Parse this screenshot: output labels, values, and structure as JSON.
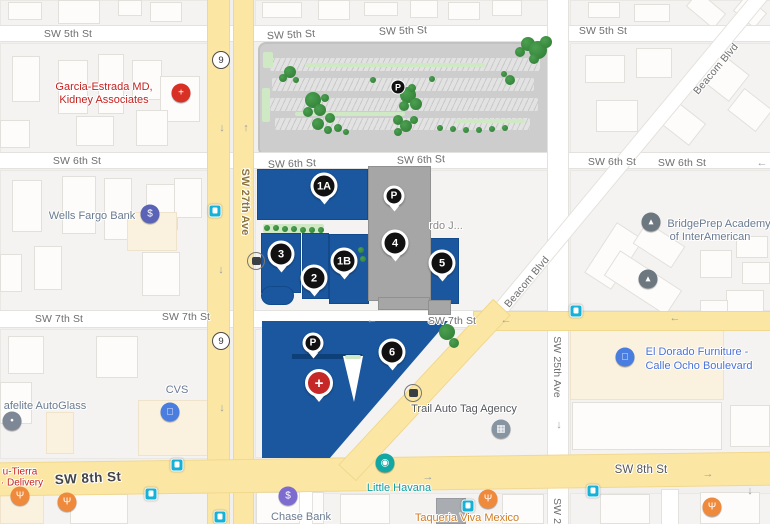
{
  "colors": {
    "campus_blue": "#1b579e",
    "building_gray": "#a6a6a6",
    "road_yellow": "#fbe7a3",
    "map_bg": "#f2f0ee",
    "tree_green": "#2e7a33",
    "transit_teal": "#16b1d6"
  },
  "streets": [
    {
      "t": "SW 5th St",
      "x": 68,
      "y": 34
    },
    {
      "t": "SW 5th St",
      "x": 291,
      "y": 35,
      "rot": -3
    },
    {
      "t": "SW 5th St",
      "x": 403,
      "y": 31,
      "rot": -2
    },
    {
      "t": "SW 5th St",
      "x": 603,
      "y": 31
    },
    {
      "t": "SW 6th St",
      "x": 77,
      "y": 161
    },
    {
      "t": "SW 6th St",
      "x": 292,
      "y": 164,
      "rot": -2
    },
    {
      "t": "SW 6th St",
      "x": 421,
      "y": 160,
      "rot": -2
    },
    {
      "t": "SW 6th St",
      "x": 612,
      "y": 162
    },
    {
      "t": "SW 6th St",
      "x": 682,
      "y": 163
    },
    {
      "t": "SW 7th St",
      "x": 59,
      "y": 319
    },
    {
      "t": "SW 7th St",
      "x": 186,
      "y": 317
    },
    {
      "t": "SW 7th St",
      "x": 452,
      "y": 321
    },
    {
      "t": "SW 8th St",
      "x": 88,
      "y": 478,
      "cls": "big",
      "rot": -3
    },
    {
      "t": "SW 8th St",
      "x": 641,
      "y": 470,
      "cls": "mid"
    },
    {
      "t": "SW 27th Ave",
      "x": 245,
      "y": 202,
      "cls": "vert ave27"
    },
    {
      "t": "SW 25th Ave",
      "x": 557,
      "y": 367,
      "cls": "vert"
    },
    {
      "t": "SW 25",
      "x": 557,
      "y": 514,
      "cls": "vert"
    },
    {
      "t": "Beacom Blvd",
      "x": 716,
      "y": 69,
      "rot": -50
    },
    {
      "t": "Beacom Blvd",
      "x": 527,
      "y": 282,
      "rot": -50
    }
  ],
  "pois": [
    {
      "t": "Garcia-Estrada MD,",
      "x": 104,
      "y": 87,
      "c": "red"
    },
    {
      "t": "Kidney Associates",
      "x": 104,
      "y": 100,
      "c": "red"
    },
    {
      "t": "Wells Fargo Bank",
      "x": 92,
      "y": 216,
      "c": "biz"
    },
    {
      "t": "BridgePrep Academy",
      "x": 719,
      "y": 224,
      "c": "biz"
    },
    {
      "t": "of InterAmerican",
      "x": 710,
      "y": 237,
      "c": "biz"
    },
    {
      "t": "rdo J...",
      "x": 446,
      "y": 226,
      "c": "gray"
    },
    {
      "t": "El Dorado Furniture -",
      "x": 697,
      "y": 352,
      "c": "blue"
    },
    {
      "t": "Calle Ocho Boulevard",
      "x": 699,
      "y": 366,
      "c": "blue"
    },
    {
      "t": "CVS",
      "x": 177,
      "y": 390,
      "c": "biz"
    },
    {
      "t": "afelite AutoGlass",
      "x": 45,
      "y": 406,
      "c": "biz"
    },
    {
      "t": "Trail Auto Tag Agency",
      "x": 464,
      "y": 409,
      "c": "dark"
    },
    {
      "t": "u-Tierra",
      "x": 20,
      "y": 472,
      "c": "red2"
    },
    {
      "t": "· Delivery",
      "x": 22,
      "y": 483,
      "c": "red2"
    },
    {
      "t": "Little Havana",
      "x": 399,
      "y": 488,
      "c": "teal"
    },
    {
      "t": "Chase Bank",
      "x": 301,
      "y": 517,
      "c": "biz"
    },
    {
      "t": "Taqueria Viva Mexico",
      "x": 467,
      "y": 518,
      "c": "orange"
    }
  ],
  "markers": [
    {
      "t": "1A",
      "x": 324,
      "y": 186,
      "k": "n"
    },
    {
      "t": "1B",
      "x": 344,
      "y": 261,
      "k": "n"
    },
    {
      "t": "2",
      "x": 314,
      "y": 278,
      "k": "n"
    },
    {
      "t": "3",
      "x": 281,
      "y": 254,
      "k": "n"
    },
    {
      "t": "4",
      "x": 395,
      "y": 243,
      "k": "n"
    },
    {
      "t": "5",
      "x": 442,
      "y": 263,
      "k": "n"
    },
    {
      "t": "6",
      "x": 392,
      "y": 352,
      "k": "n"
    },
    {
      "t": "P",
      "x": 394,
      "y": 196,
      "k": "p"
    },
    {
      "t": "P",
      "x": 313,
      "y": 343,
      "k": "p"
    },
    {
      "t": "P",
      "x": 398,
      "y": 87,
      "k": "pp"
    },
    {
      "t": "+",
      "x": 319,
      "y": 383,
      "k": "x"
    }
  ],
  "pins": [
    {
      "g": "+",
      "x": 181,
      "y": 93,
      "c": "#d93025",
      "name": "medical-pin"
    },
    {
      "g": "$",
      "x": 150,
      "y": 214,
      "c": "#5b63b7",
      "name": "bank-dollar-pin"
    },
    {
      "g": "▴",
      "x": 651,
      "y": 222,
      "c": "#6d7780",
      "name": "school-pin"
    },
    {
      "g": "▴",
      "x": 648,
      "y": 279,
      "c": "#6d7780",
      "name": "school-pin"
    },
    {
      "g": "□",
      "x": 625,
      "y": 357,
      "c": "#4a7de0",
      "name": "shopping-pin"
    },
    {
      "g": "□",
      "x": 170,
      "y": 412,
      "c": "#4a7de0",
      "name": "shopping-pin"
    },
    {
      "g": "•",
      "x": 12,
      "y": 421,
      "c": "#7d8795",
      "name": "generic-pin"
    },
    {
      "g": "◉",
      "x": 385,
      "y": 463,
      "c": "#12a7a3",
      "name": "camera-pin"
    },
    {
      "g": "Ψ",
      "x": 488,
      "y": 499,
      "c": "#ef8a3c",
      "name": "restaurant-pin"
    },
    {
      "g": "Ψ",
      "x": 712,
      "y": 507,
      "c": "#ef8a3c",
      "name": "restaurant-pin"
    },
    {
      "g": "Ψ",
      "x": 20,
      "y": 496,
      "c": "#ef8a3c",
      "name": "restaurant-pin"
    },
    {
      "g": "Ψ",
      "x": 67,
      "y": 502,
      "c": "#ef8a3c",
      "name": "restaurant-pin"
    },
    {
      "g": "$",
      "x": 288,
      "y": 496,
      "c": "#7e6bd0",
      "name": "bank-dollar-pin"
    },
    {
      "g": "▦",
      "x": 501,
      "y": 429,
      "c": "#8795a3",
      "name": "bank-pin"
    },
    {
      "g": "bus",
      "x": 256,
      "y": 261,
      "c": "#ffffff",
      "name": "bus-stop-icon"
    },
    {
      "g": "bus",
      "x": 413,
      "y": 393,
      "c": "#ffffff",
      "name": "bus-stop-icon"
    }
  ],
  "shields": [
    {
      "t": "9",
      "x": 221,
      "y": 60
    },
    {
      "t": "9",
      "x": 221,
      "y": 341
    }
  ],
  "arrows": [
    {
      "t": "↓",
      "x": 222,
      "y": 128
    },
    {
      "t": "↑",
      "x": 246,
      "y": 128
    },
    {
      "t": "↓",
      "x": 221,
      "y": 270
    },
    {
      "t": "↓",
      "x": 222,
      "y": 408
    },
    {
      "t": "←",
      "x": 762,
      "y": 163
    },
    {
      "t": "←",
      "x": 372,
      "y": 320
    },
    {
      "t": "←",
      "x": 506,
      "y": 320
    },
    {
      "t": "←",
      "x": 675,
      "y": 318
    },
    {
      "t": "→",
      "x": 428,
      "y": 477
    },
    {
      "t": "→",
      "x": 708,
      "y": 474
    },
    {
      "t": "↓",
      "x": 559,
      "y": 425
    },
    {
      "t": "↓",
      "x": 750,
      "y": 491
    }
  ],
  "transit": [
    [
      215,
      211
    ],
    [
      576,
      311
    ],
    [
      177,
      465
    ],
    [
      151,
      494
    ],
    [
      468,
      506
    ],
    [
      593,
      491
    ],
    [
      220,
      517
    ]
  ],
  "trees": [
    [
      528,
      44,
      7
    ],
    [
      538,
      50,
      9
    ],
    [
      546,
      42,
      6
    ],
    [
      520,
      52,
      5
    ],
    [
      534,
      59,
      5
    ],
    [
      290,
      72,
      6
    ],
    [
      283,
      78,
      4
    ],
    [
      296,
      80,
      3
    ],
    [
      313,
      100,
      8
    ],
    [
      320,
      110,
      6
    ],
    [
      308,
      112,
      5
    ],
    [
      325,
      98,
      4
    ],
    [
      330,
      118,
      5
    ],
    [
      318,
      124,
      6
    ],
    [
      328,
      130,
      4
    ],
    [
      338,
      128,
      4
    ],
    [
      346,
      132,
      3
    ],
    [
      408,
      95,
      8
    ],
    [
      416,
      104,
      6
    ],
    [
      404,
      106,
      5
    ],
    [
      412,
      88,
      4
    ],
    [
      398,
      120,
      5
    ],
    [
      406,
      126,
      6
    ],
    [
      414,
      120,
      4
    ],
    [
      398,
      132,
      4
    ],
    [
      440,
      128,
      3
    ],
    [
      453,
      129,
      3
    ],
    [
      466,
      130,
      3
    ],
    [
      479,
      130,
      3
    ],
    [
      492,
      129,
      3
    ],
    [
      505,
      128,
      3
    ],
    [
      510,
      80,
      5
    ],
    [
      504,
      74,
      3
    ],
    [
      432,
      79,
      3
    ],
    [
      373,
      80,
      3
    ],
    [
      267,
      228,
      3
    ],
    [
      276,
      228,
      3
    ],
    [
      285,
      229,
      3
    ],
    [
      294,
      229,
      3
    ],
    [
      303,
      230,
      3
    ],
    [
      312,
      230,
      3
    ],
    [
      321,
      230,
      3
    ],
    [
      361,
      250,
      3
    ],
    [
      363,
      259,
      3
    ],
    [
      447,
      332,
      8
    ],
    [
      454,
      343,
      5
    ]
  ],
  "greens": [
    [
      305,
      63,
      180,
      4
    ],
    [
      295,
      112,
      110,
      4
    ],
    [
      455,
      119,
      70,
      4
    ],
    [
      262,
      88,
      8,
      34
    ],
    [
      263,
      52,
      10,
      16
    ],
    [
      263,
      224,
      61,
      9
    ],
    [
      345,
      355,
      16,
      4
    ]
  ],
  "decor": {
    "bases": [
      [
        0,
        0,
        206,
        25
      ],
      [
        255,
        0,
        291,
        25
      ],
      [
        570,
        0,
        200,
        25
      ],
      [
        0,
        43,
        206,
        108
      ],
      [
        570,
        43,
        200,
        108
      ],
      [
        0,
        170,
        206,
        139
      ],
      [
        255,
        170,
        291,
        139
      ],
      [
        570,
        170,
        200,
        139
      ],
      [
        0,
        329,
        206,
        128
      ],
      [
        255,
        329,
        291,
        127
      ],
      [
        570,
        329,
        200,
        127
      ],
      [
        0,
        493,
        206,
        31
      ],
      [
        255,
        493,
        291,
        31
      ],
      [
        570,
        493,
        200,
        31
      ]
    ],
    "buildings": [
      [
        8,
        2,
        32,
        16
      ],
      [
        58,
        0,
        40,
        22
      ],
      [
        118,
        0,
        22,
        14
      ],
      [
        150,
        2,
        30,
        18
      ],
      [
        262,
        2,
        38,
        14
      ],
      [
        318,
        0,
        30,
        18
      ],
      [
        364,
        2,
        32,
        12
      ],
      [
        410,
        0,
        26,
        16
      ],
      [
        448,
        2,
        30,
        16
      ],
      [
        492,
        0,
        28,
        14
      ],
      [
        588,
        2,
        30,
        14
      ],
      [
        634,
        4,
        34,
        16
      ],
      [
        688,
        0,
        34,
        18,
        "",
        40
      ],
      [
        736,
        2,
        26,
        18,
        "",
        40
      ],
      [
        12,
        56,
        26,
        44
      ],
      [
        58,
        60,
        28,
        52
      ],
      [
        98,
        54,
        24,
        58
      ],
      [
        132,
        60,
        28,
        38
      ],
      [
        160,
        76,
        38,
        44
      ],
      [
        0,
        120,
        28,
        26
      ],
      [
        76,
        116,
        36,
        28
      ],
      [
        136,
        110,
        30,
        34
      ],
      [
        585,
        55,
        38,
        26
      ],
      [
        636,
        48,
        34,
        28
      ],
      [
        700,
        58,
        42,
        32,
        "",
        38
      ],
      [
        596,
        100,
        40,
        30
      ],
      [
        660,
        108,
        40,
        26,
        "",
        38
      ],
      [
        732,
        96,
        34,
        26,
        "",
        38
      ],
      [
        12,
        180,
        28,
        50
      ],
      [
        62,
        176,
        32,
        56
      ],
      [
        104,
        178,
        26,
        60
      ],
      [
        146,
        184,
        30,
        44
      ],
      [
        34,
        246,
        26,
        42
      ],
      [
        0,
        254,
        20,
        36
      ],
      [
        142,
        252,
        36,
        42
      ],
      [
        174,
        178,
        26,
        38
      ],
      [
        127,
        212,
        48,
        37,
        "cream"
      ],
      [
        598,
        226,
        30,
        58,
        "",
        33
      ],
      [
        606,
        268,
        72,
        28,
        "",
        33
      ],
      [
        636,
        232,
        44,
        24,
        "",
        33
      ],
      [
        700,
        250,
        30,
        26
      ],
      [
        736,
        236,
        30,
        20
      ],
      [
        742,
        262,
        26,
        20
      ],
      [
        726,
        290,
        36,
        26
      ],
      [
        700,
        300,
        26,
        20
      ],
      [
        8,
        336,
        34,
        36
      ],
      [
        96,
        336,
        40,
        40
      ],
      [
        0,
        382,
        30,
        40
      ],
      [
        138,
        400,
        72,
        54,
        "cream"
      ],
      [
        46,
        412,
        26,
        40,
        "cream"
      ],
      [
        0,
        492,
        42,
        30,
        "cream"
      ],
      [
        570,
        330,
        152,
        68,
        "cream"
      ],
      [
        572,
        402,
        148,
        46
      ],
      [
        730,
        405,
        38,
        40
      ],
      [
        70,
        494,
        56,
        28
      ],
      [
        256,
        492,
        66,
        30
      ],
      [
        340,
        494,
        48,
        28
      ],
      [
        436,
        498,
        28,
        24,
        "dark"
      ],
      [
        502,
        494,
        40,
        28
      ],
      [
        600,
        494,
        48,
        28
      ],
      [
        700,
        492,
        58,
        30
      ]
    ],
    "roadsW": [
      [
        0,
        26,
        770,
        15
      ],
      [
        0,
        153,
        770,
        15
      ],
      [
        0,
        311,
        492,
        16
      ],
      [
        548,
        0,
        20,
        524
      ],
      [
        300,
        492,
        12,
        32
      ],
      [
        662,
        490,
        16,
        34
      ]
    ],
    "diagW": [
      [
        418,
        149,
        420,
        14,
        -50.3
      ]
    ],
    "roadsY": [
      [
        208,
        0,
        21,
        524
      ],
      [
        234,
        0,
        19,
        524
      ],
      [
        474,
        312,
        296,
        18
      ],
      [
        -5,
        458,
        781,
        32,
        -0.8
      ]
    ],
    "diagY": [
      [
        312,
        379,
        225,
        22,
        -47
      ]
    ],
    "campusBlue": [
      [
        257,
        169,
        109,
        49
      ],
      [
        261,
        233,
        38,
        58
      ],
      [
        261,
        286,
        31,
        17,
        14
      ],
      [
        302,
        233,
        25,
        64
      ],
      [
        329,
        234,
        38,
        68
      ],
      [
        429,
        238,
        28,
        64
      ]
    ],
    "campusGray": [
      [
        368,
        166,
        61,
        133
      ],
      [
        378,
        297,
        50,
        11
      ],
      [
        428,
        300,
        21,
        13
      ]
    ],
    "south": [
      262,
      321,
      186,
      137
    ],
    "navy": [
      292,
      354,
      70,
      5
    ],
    "notch": [
      343,
      356,
      20,
      46
    ],
    "parking": {
      "lot": [
        258,
        42,
        296,
        110
      ],
      "rows": [
        [
          270,
          58,
          270,
          13
        ],
        [
          272,
          78,
          262,
          13
        ],
        [
          270,
          98,
          268,
          13
        ],
        [
          275,
          118,
          255,
          12
        ]
      ]
    }
  }
}
